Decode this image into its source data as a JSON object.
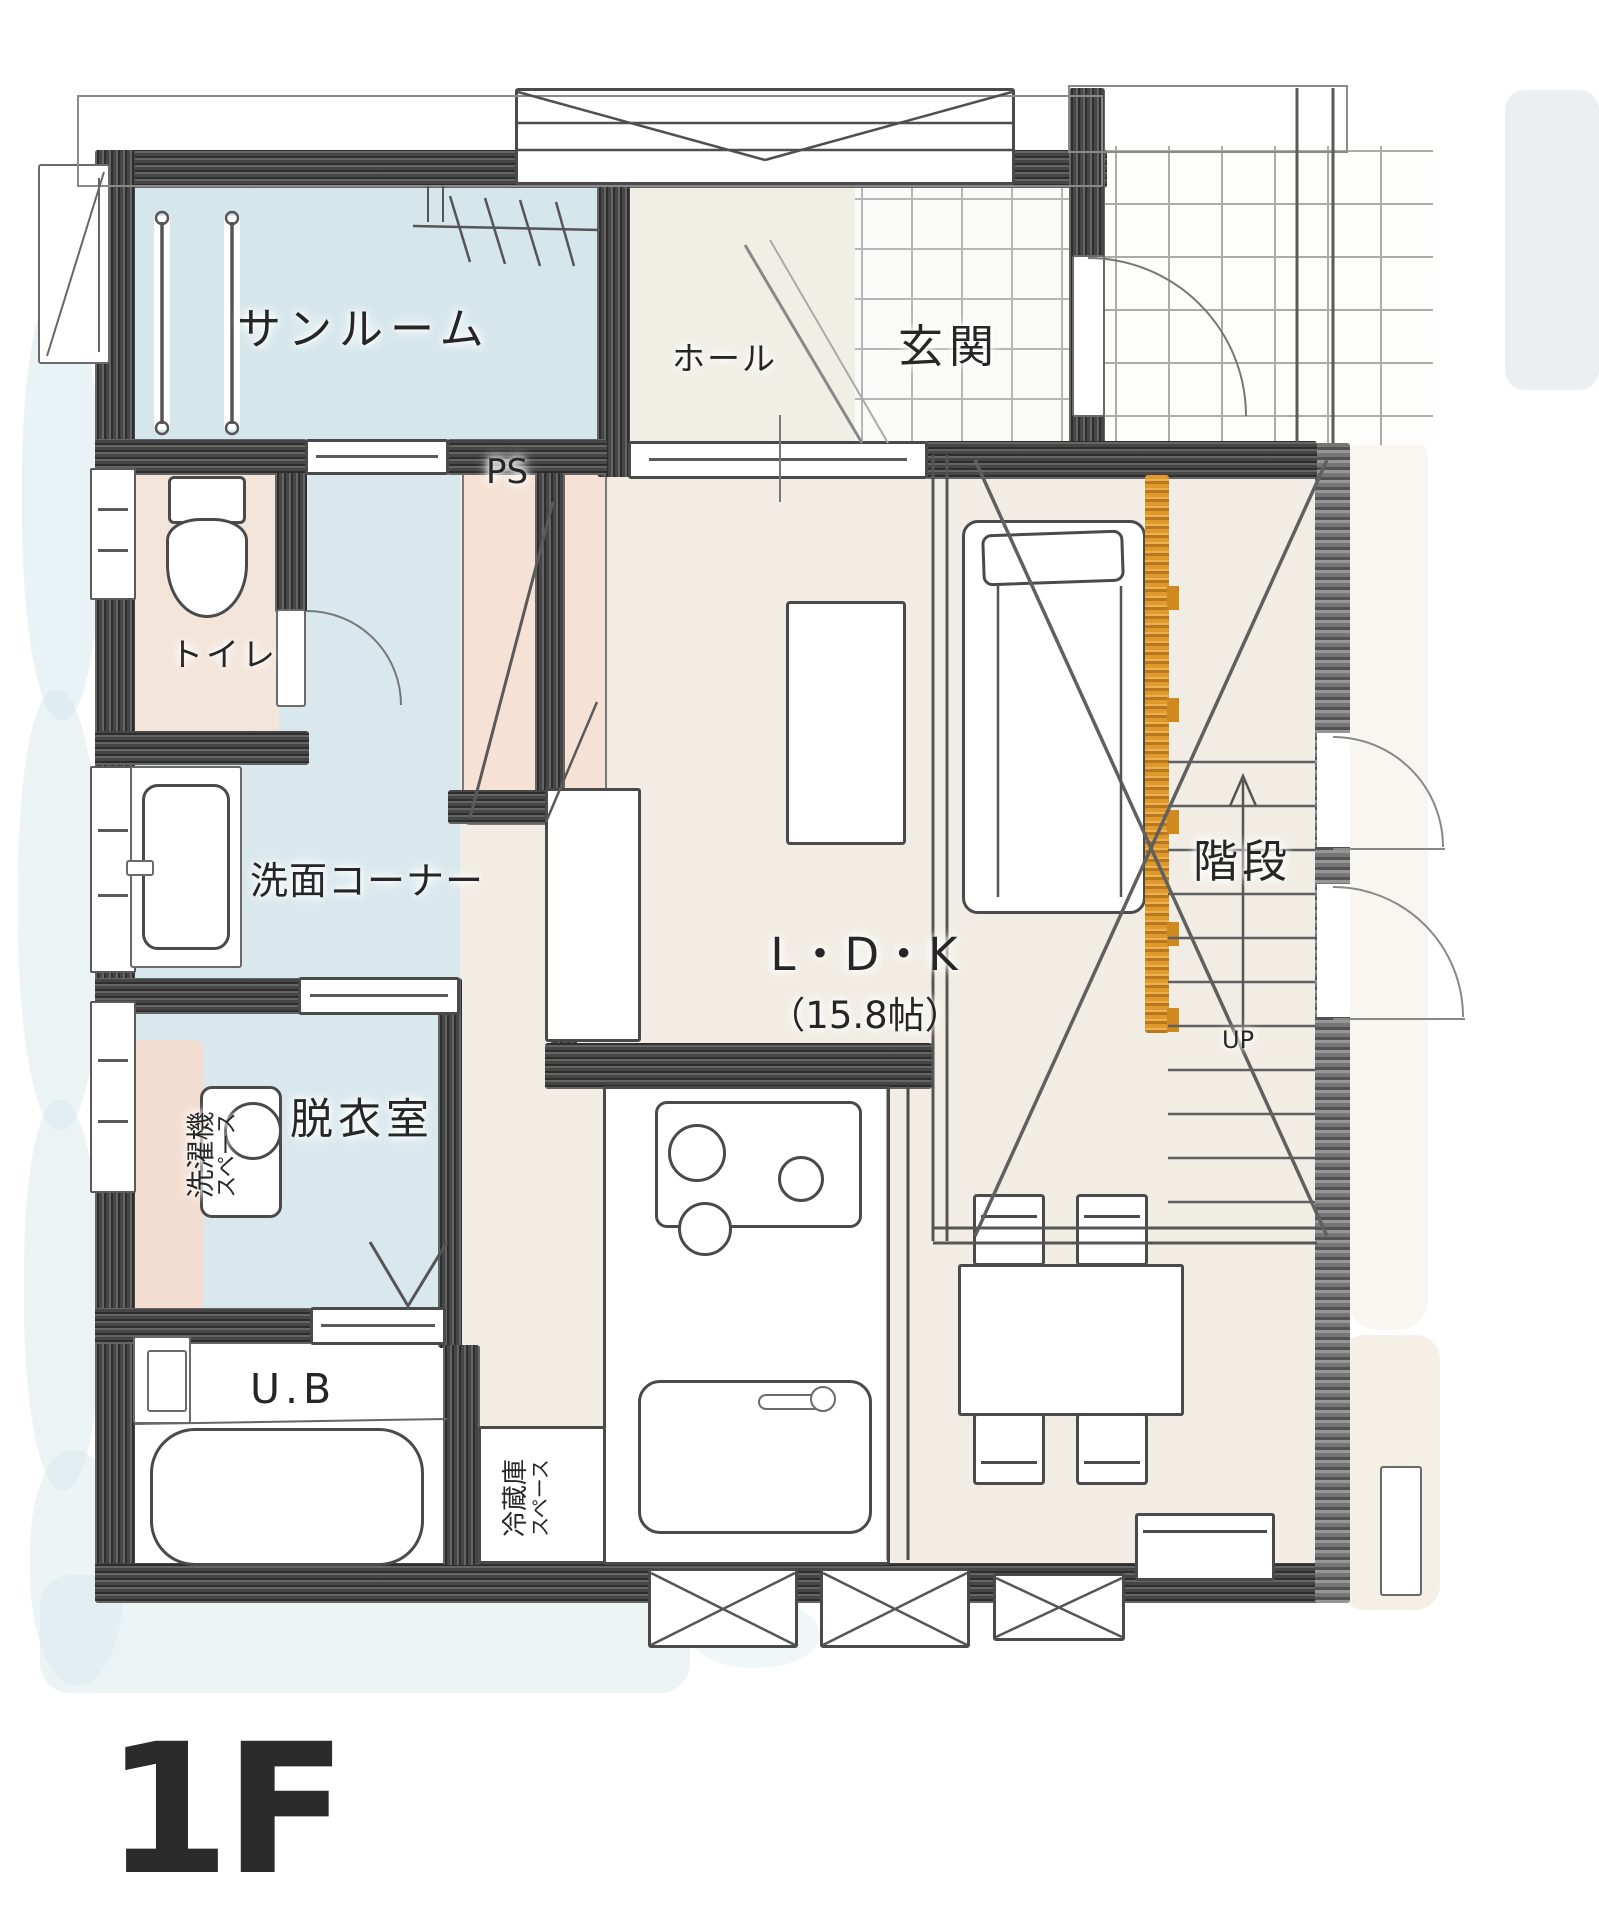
{
  "floor_label": "1F",
  "labels": {
    "sunroom": "サンルーム",
    "hall": "ホール",
    "entrance": "玄関",
    "pipe_space": "PS",
    "toilet": "トイレ",
    "wash_corner": "洗面コーナー",
    "dressing_room": "脱衣室",
    "laundry_machine": "洗濯機",
    "laundry_space": "スペース",
    "unit_bath": "U.B",
    "fridge": "冷蔵庫",
    "fridge_space": "スペース",
    "ldk_name": "L・D・K",
    "ldk_size": "（15.8帖）",
    "stairs": "階段",
    "stairs_up": "UP"
  },
  "colors": {
    "wall_dark": "#3f3f40",
    "wall_light": "#6e6e6e",
    "water_blue": "#d7e7ec",
    "floor_cream": "#f1ede4",
    "closet_pink": "#f5e2d4",
    "accent_orange": "#e0992d",
    "text": "#262626"
  }
}
